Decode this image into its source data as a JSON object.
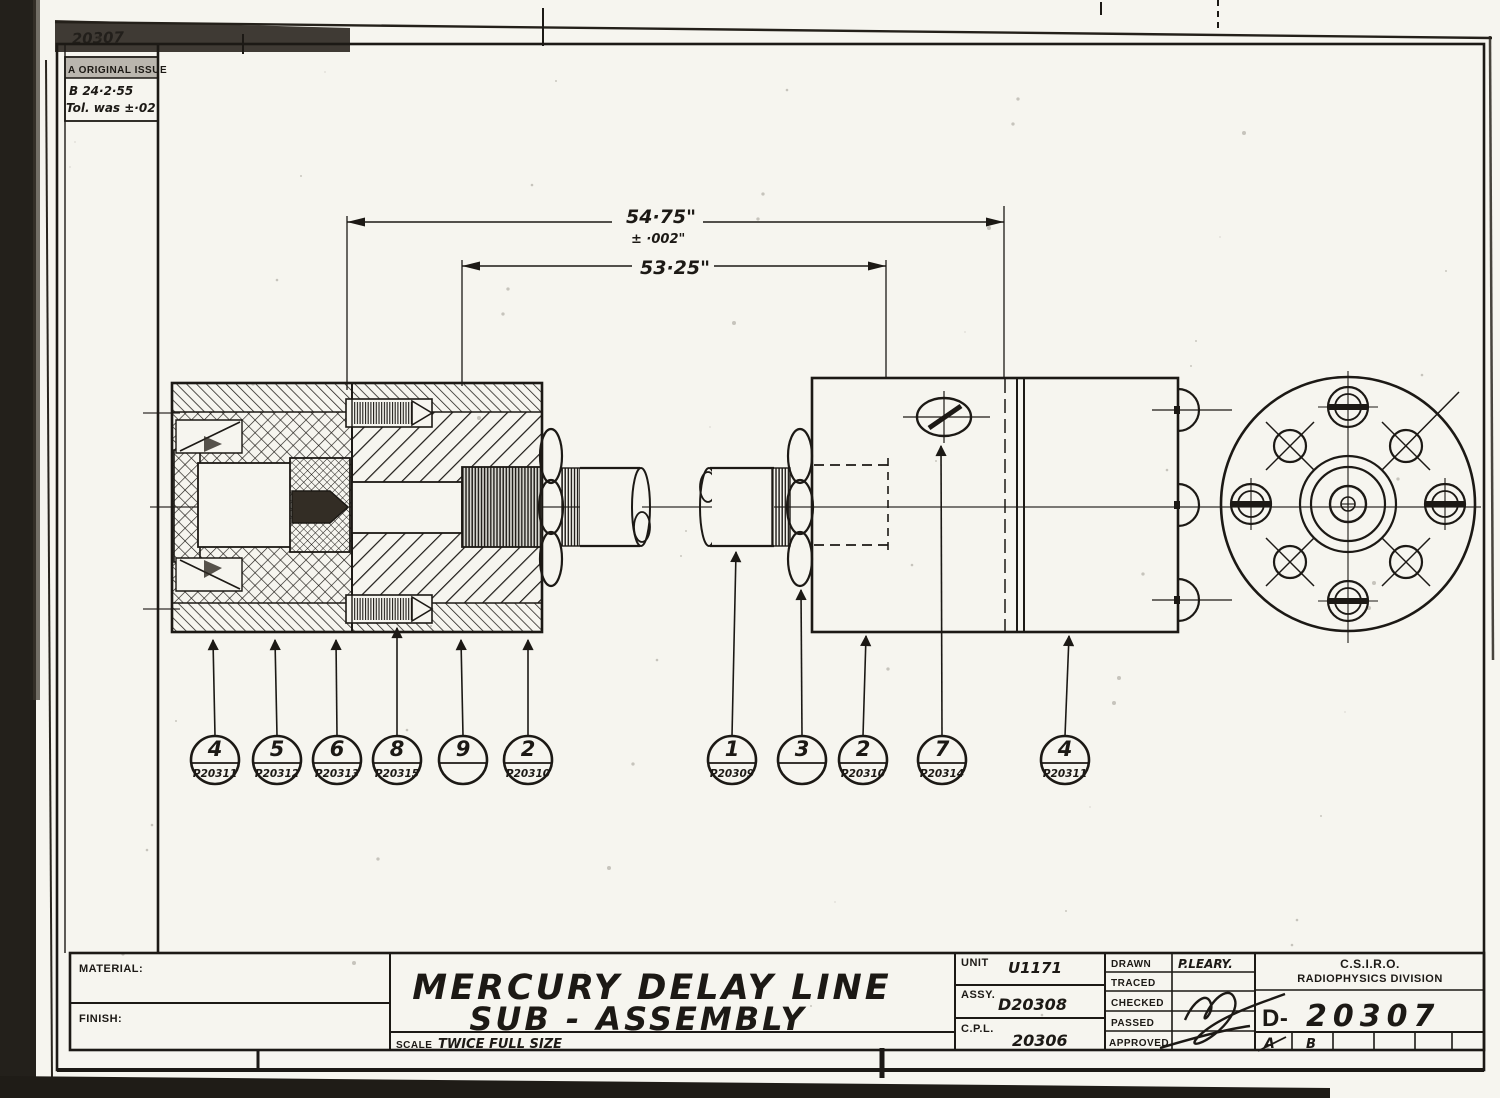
{
  "sheet": {
    "corner_scribble": "20307",
    "revision_box": {
      "row_a": "A ORIGINAL ISSUE",
      "row_b": "B  24·2·55",
      "row_b_note": "Tol. was ±·02"
    },
    "dimensions": {
      "overall": "54·75\"",
      "overall_tolerance": "± ·002\"",
      "inner": "53·25\""
    },
    "callouts": [
      {
        "item": "4",
        "part": "P20311"
      },
      {
        "item": "5",
        "part": "P20312"
      },
      {
        "item": "6",
        "part": "P20313"
      },
      {
        "item": "8",
        "part": "P20315"
      },
      {
        "item": "9",
        "part": ""
      },
      {
        "item": "2",
        "part": "P20310"
      },
      {
        "item": "1",
        "part": "P20309"
      },
      {
        "item": "3",
        "part": ""
      },
      {
        "item": "2",
        "part": "P20310"
      },
      {
        "item": "7",
        "part": "P20314"
      },
      {
        "item": "4",
        "part": "P20311"
      }
    ],
    "title_block": {
      "material_label": "MATERIAL:",
      "finish_label": "FINISH:",
      "title_line1": "MERCURY DELAY LINE",
      "title_line2": "SUB - ASSEMBLY",
      "scale_label": "SCALE",
      "scale_value": "TWICE FULL SIZE",
      "unit_label": "UNIT",
      "unit_value": "U1171",
      "assy_label": "ASSY.",
      "assy_value": "D20308",
      "cpl_label": "C.P.L.",
      "cpl_value": "20306",
      "drawn_label": "DRAWN",
      "drawn_value": "P.LEARY.",
      "traced_label": "TRACED",
      "checked_label": "CHECKED",
      "passed_label": "PASSED",
      "approved_label": "APPROVED",
      "org_line1": "C.S.I.R.O.",
      "org_line2": "RADIOPHYSICS DIVISION",
      "drawing_prefix": "D-",
      "drawing_number": "20307",
      "rev_cell_a": "A",
      "rev_cell_b": "B"
    }
  }
}
